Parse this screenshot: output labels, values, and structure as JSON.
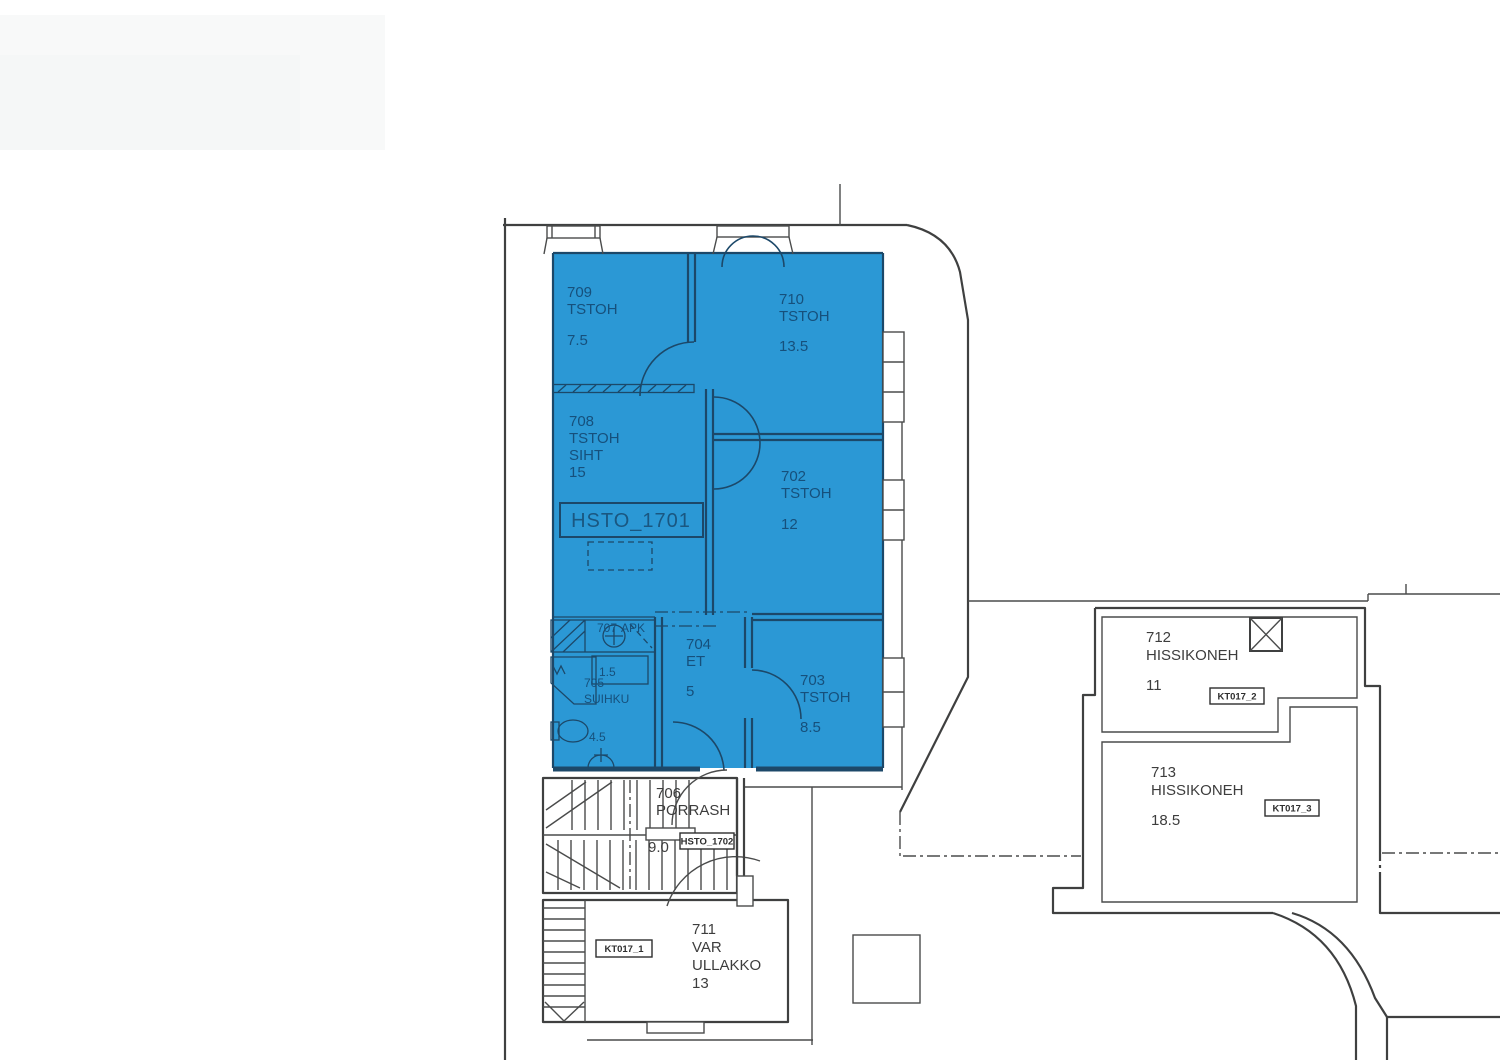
{
  "plan": {
    "unit_box_label": "HSTO_1701",
    "colors": {
      "apartment_fill": "#2b98d5",
      "gray_room_fill": "#ecedec",
      "wall": "#3f4040",
      "blue_text": "#16507c",
      "gray_text": "#3d3d3d"
    },
    "rooms": {
      "r709": {
        "number": "709",
        "type": "TSTOH",
        "area": "7.5"
      },
      "r710": {
        "number": "710",
        "type": "TSTOH",
        "area": "13.5"
      },
      "r708": {
        "number": "708",
        "type": "TSTOH",
        "extra": "SIHT",
        "area": "15"
      },
      "r702": {
        "number": "702",
        "type": "TSTOH",
        "area": "12"
      },
      "r703": {
        "number": "703",
        "type": "TSTOH",
        "area": "8.5"
      },
      "r704": {
        "number": "704",
        "type": "ET",
        "area": "5"
      },
      "r705": {
        "number": "705",
        "type": "SUIHKU",
        "area": "4.5"
      },
      "r707": {
        "number": "707",
        "type": "APK",
        "area": "1.5"
      },
      "r706": {
        "number": "706",
        "type": "PORRASH",
        "area": "9.0"
      },
      "r711": {
        "number": "711",
        "type": "VAR",
        "extra": "ULLAKKO",
        "area": "13"
      },
      "r712": {
        "number": "712",
        "type": "HISSIKONEH",
        "area": "11"
      },
      "r713": {
        "number": "713",
        "type": "HISSIKONEH",
        "area": "18.5"
      }
    },
    "badges": {
      "hsto_1702": "HSTO_1702",
      "kt017_1": "KT017_1",
      "kt017_2": "KT017_2",
      "kt017_3": "KT017_3"
    }
  }
}
